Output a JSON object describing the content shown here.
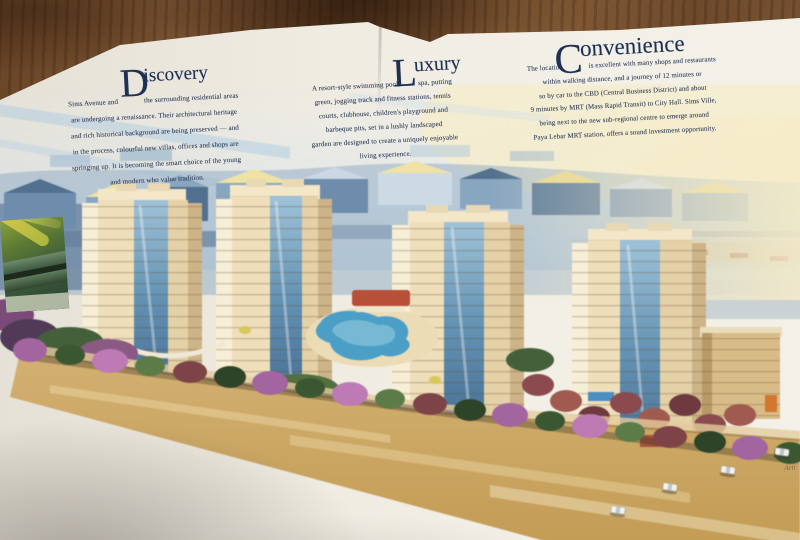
{
  "sections": [
    {
      "id": "discovery",
      "initial": "D",
      "title_rest": "iscovery",
      "line1_left": "Sims Avenue and",
      "line1_right": "the surrounding residential areas",
      "lines": [
        "are undergoing a renaissance. Their architectural heritage",
        "and rich historical background are being preserved — and",
        "in the process, colourful new villas, offices and shops are",
        "springing up. It is becoming the smart choice of the young",
        "and modern who value tradition."
      ]
    },
    {
      "id": "luxury",
      "initial": "L",
      "title_rest": "uxury",
      "line1_left": "A resort-style swimming pool,",
      "line1_right": "spa, putting",
      "lines": [
        "green, jogging track and fitness stations, tennis",
        "courts, clubhouse, children's playground and",
        "barbeque pits, set in a lushly landscaped",
        "garden are designed to create a uniquely enjoyable",
        "living experience."
      ]
    },
    {
      "id": "convenience",
      "initial": "C",
      "title_rest": "onvenience",
      "line1_left": "The location",
      "line1_right": "is excellent with many shops and restaurants",
      "lines": [
        "within walking distance, and a journey of 12 minutes or",
        "so by car to the CBD (Central Business District) and about",
        "9 minutes by MRT (Mass Rapid Transit) to City Hall. Sims Ville,",
        "being next to the new sub-regional centre to emerge around",
        "Paya Lebar MRT station, offers a sound investment opportunity."
      ]
    }
  ],
  "caption": {
    "fragment": "Arti"
  },
  "artwork": {
    "towers": 4
  },
  "colors": {
    "paper": "#f0ece2",
    "ink": "#33405c",
    "title_ink": "#1e3054",
    "wood": "#6f4a2b",
    "sky_blue": "#aecbe2",
    "sky_cream": "#f6ecc9",
    "city_blue": "#7e99b7",
    "tower_cream": "#eddcb6",
    "tower_shade": "#cdb488",
    "tower_glass": "#5f8fb2",
    "tree_purple": "#a265a0",
    "tree_green": "#4e6c3a",
    "tree_maroon": "#7e4347",
    "pool_blue": "#4b9fc6",
    "roof_red": "#b84f38",
    "road_tan": "#c9a55e"
  }
}
